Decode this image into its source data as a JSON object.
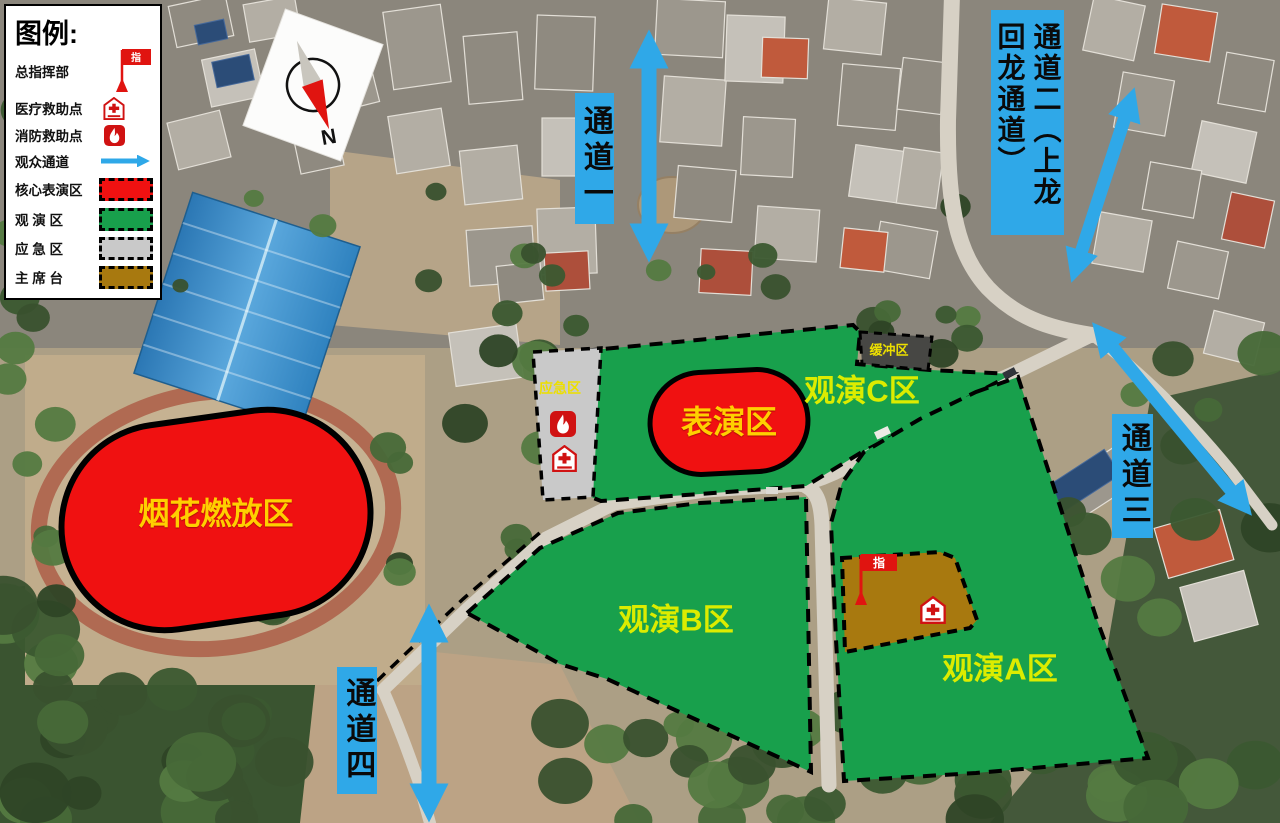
{
  "legend": {
    "title": "图例:",
    "items": [
      {
        "label": "总指挥部",
        "icon": "command-flag",
        "flag_char": "指"
      },
      {
        "label": "医疗救助点",
        "icon": "medical-shield"
      },
      {
        "label": "消防救助点",
        "icon": "fire"
      },
      {
        "label": "观众通道",
        "icon": "blue-arrow"
      },
      {
        "label": "核心表演区",
        "icon": "swatch",
        "color": "#F01111"
      },
      {
        "label": "观 演 区",
        "icon": "swatch",
        "color": "#18A04C"
      },
      {
        "label": "应 急 区",
        "icon": "swatch",
        "color": "#C9C9C9"
      },
      {
        "label": "主 席 台",
        "icon": "swatch",
        "color": "#A8790F"
      }
    ]
  },
  "compass": {
    "north_label": "N"
  },
  "zones": {
    "fireworks": {
      "label": "烟花燃放区",
      "color": "#F01111"
    },
    "performance": {
      "label": "表演区",
      "color": "#F01111"
    },
    "viewing_c": {
      "label": "观演C区",
      "color": "#18A04C"
    },
    "viewing_b": {
      "label": "观演B区",
      "color": "#18A04C"
    },
    "viewing_a": {
      "label": "观演A区",
      "color": "#18A04C"
    },
    "emergency": {
      "label": "应急区",
      "color": "#C9C9C9"
    },
    "buffer": {
      "label": "缓冲区",
      "color": "#474744"
    },
    "rostrum": {
      "flag_char": "指",
      "color": "#A8790F"
    }
  },
  "channels": [
    {
      "label": "通道一"
    },
    {
      "label": "通道二（上龙回龙通道）"
    },
    {
      "label": "通道三"
    },
    {
      "label": "通道四"
    }
  ],
  "colors": {
    "channel_blue": "#2FA8E8",
    "gold_label": "#FFCF00",
    "green_label": "#DCEC00"
  }
}
